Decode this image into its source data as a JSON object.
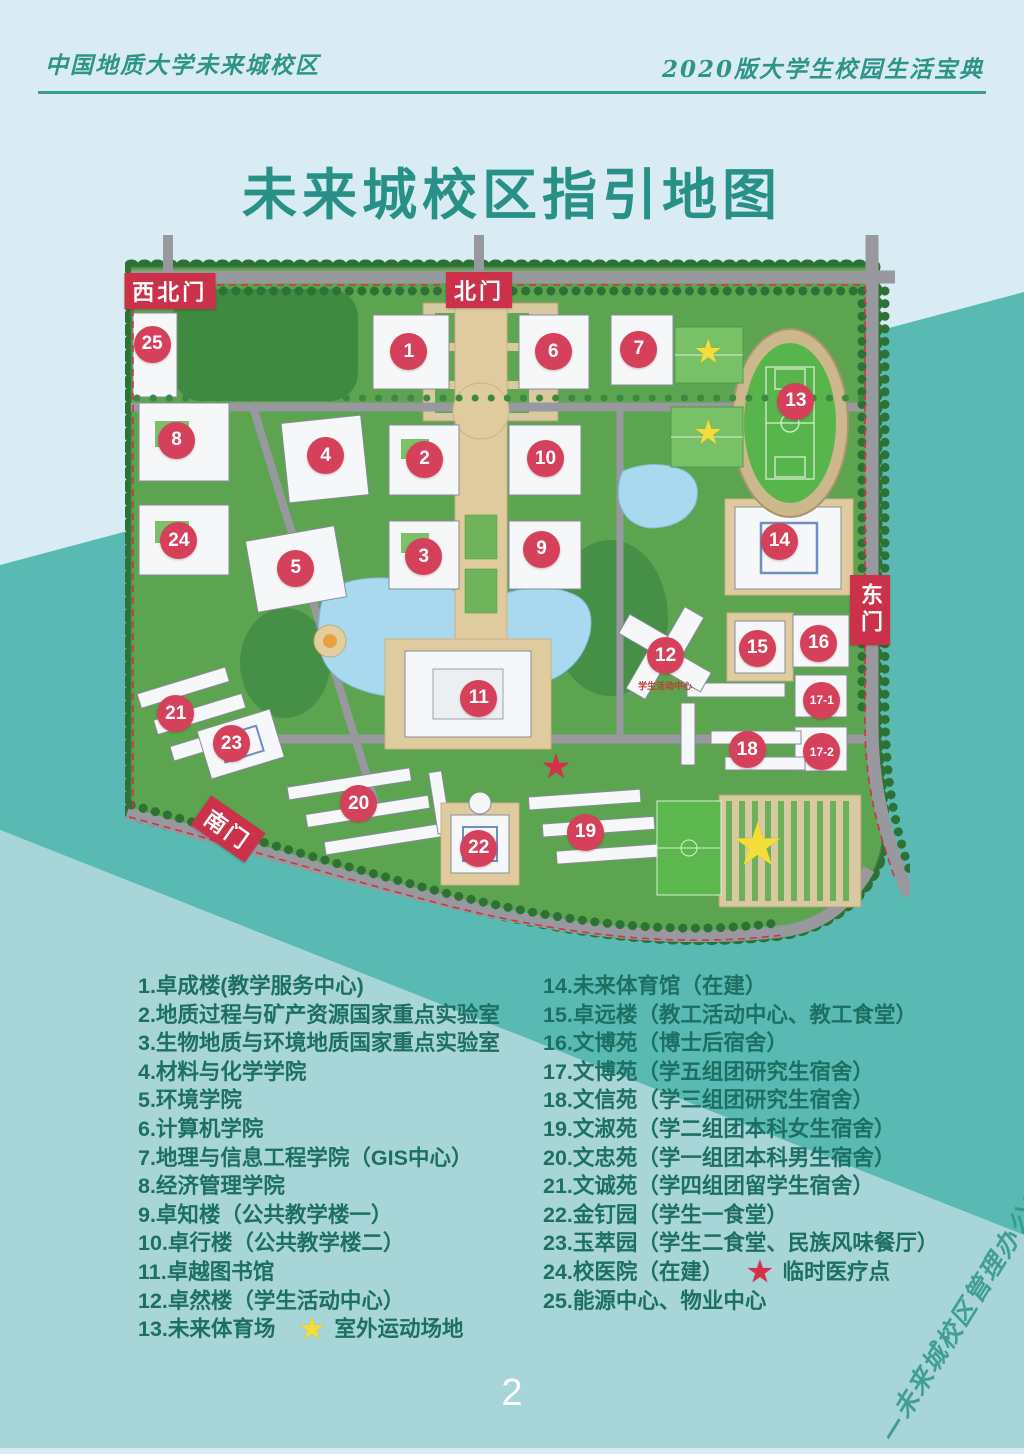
{
  "header": {
    "left": "中国地质大学未来城校区",
    "right": "2020版大学生校园生活宝典"
  },
  "title": "未来城校区指引地图",
  "page_number": "2",
  "watermark": "—未来城校区管理办公室—",
  "colors": {
    "page_bg": "#d9ecf3",
    "band_dark_teal": "#58bab2",
    "band_light_teal": "#a8d5d7",
    "header_teal": "#2e9488",
    "title_teal": "#289187",
    "legend_green": "#1d6f63",
    "marker_red": "#d5405a",
    "gate_red": "#cb3148",
    "star_yellow": "#f2dd3b",
    "star_red": "#d5304a"
  },
  "map": {
    "gates": [
      {
        "label": "西北门",
        "x": 5.7,
        "y": 7.9,
        "vertical": false,
        "rotate": 0
      },
      {
        "label": "北门",
        "x": 45.1,
        "y": 7.8,
        "vertical": false,
        "rotate": 0
      },
      {
        "label": "东门",
        "x": 94.9,
        "y": 51.4,
        "vertical": true,
        "rotate": 0
      },
      {
        "label": "南门",
        "x": 13.1,
        "y": 81.3,
        "vertical": false,
        "rotate": 35
      }
    ],
    "markers": [
      {
        "label": "1",
        "x": 36.1,
        "y": 16.1
      },
      {
        "label": "2",
        "x": 38.1,
        "y": 30.8
      },
      {
        "label": "3",
        "x": 38.0,
        "y": 44.1
      },
      {
        "label": "4",
        "x": 25.5,
        "y": 30.3
      },
      {
        "label": "5",
        "x": 21.7,
        "y": 45.7
      },
      {
        "label": "6",
        "x": 54.5,
        "y": 16.1
      },
      {
        "label": "7",
        "x": 65.4,
        "y": 15.8
      },
      {
        "label": "8",
        "x": 6.5,
        "y": 28.2
      },
      {
        "label": "9",
        "x": 53.0,
        "y": 43.1
      },
      {
        "label": "10",
        "x": 53.5,
        "y": 30.7
      },
      {
        "label": "11",
        "x": 45.0,
        "y": 63.4
      },
      {
        "label": "12",
        "x": 68.8,
        "y": 57.6
      },
      {
        "label": "13",
        "x": 85.4,
        "y": 22.9
      },
      {
        "label": "14",
        "x": 83.3,
        "y": 42.0
      },
      {
        "label": "15",
        "x": 80.5,
        "y": 56.6
      },
      {
        "label": "16",
        "x": 88.3,
        "y": 55.9
      },
      {
        "label": "17-1",
        "x": 88.7,
        "y": 63.7
      },
      {
        "label": "17-2",
        "x": 88.7,
        "y": 70.7
      },
      {
        "label": "18",
        "x": 79.2,
        "y": 70.4
      },
      {
        "label": "19",
        "x": 58.6,
        "y": 81.7
      },
      {
        "label": "20",
        "x": 29.7,
        "y": 77.8
      },
      {
        "label": "21",
        "x": 6.4,
        "y": 65.5
      },
      {
        "label": "22",
        "x": 45.0,
        "y": 83.9
      },
      {
        "label": "23",
        "x": 13.5,
        "y": 69.6
      },
      {
        "label": "24",
        "x": 6.8,
        "y": 41.9
      },
      {
        "label": "25",
        "x": 3.4,
        "y": 15.1
      }
    ],
    "stars": [
      {
        "color": "yellow",
        "x": 74.3,
        "y": 16.2,
        "size": 34
      },
      {
        "color": "yellow",
        "x": 74.3,
        "y": 27.3,
        "size": 34
      },
      {
        "color": "yellow",
        "x": 80.6,
        "y": 83.5,
        "size": 60
      },
      {
        "color": "red",
        "x": 54.9,
        "y": 72.9,
        "size": 34
      }
    ],
    "annotations": [
      {
        "text": "学生活动中心",
        "x": 68.8,
        "y": 60.8
      }
    ]
  },
  "legend": {
    "left": [
      {
        "text": "1.卓成楼(教学服务中心)"
      },
      {
        "text": "2.地质过程与矿产资源国家重点实验室"
      },
      {
        "text": "3.生物地质与环境地质国家重点实验室"
      },
      {
        "text": "4.材料与化学学院"
      },
      {
        "text": "5.环境学院"
      },
      {
        "text": "6.计算机学院"
      },
      {
        "text": "7.地理与信息工程学院（GIS中心）"
      },
      {
        "text": "8.经济管理学院"
      },
      {
        "text": " 9.卓知楼（公共教学楼一）"
      },
      {
        "text": "10.卓行楼（公共教学楼二）"
      },
      {
        "text": "11.卓越图书馆"
      },
      {
        "text": "12.卓然楼（学生活动中心）"
      },
      {
        "text": "13.未来体育场",
        "star": "yellow",
        "suffix": "室外运动场地"
      }
    ],
    "right": [
      {
        "text": "14.未来体育馆（在建）"
      },
      {
        "text": "15.卓远楼（教工活动中心、教工食堂）"
      },
      {
        "text": "16.文博苑（博士后宿舍）"
      },
      {
        "text": "17.文博苑（学五组团研究生宿舍）"
      },
      {
        "text": "18.文信苑（学三组团研究生宿舍）"
      },
      {
        "text": "19.文淑苑（学二组团本科女生宿舍）"
      },
      {
        "text": "20.文忠苑（学一组团本科男生宿舍）"
      },
      {
        "text": "21.文诚苑（学四组团留学生宿舍）"
      },
      {
        "text": "22.金钉园（学生一食堂）"
      },
      {
        "text": "23.玉萃园（学生二食堂、民族风味餐厅）"
      },
      {
        "text": "24.校医院（在建）",
        "star": "red",
        "suffix": "临时医疗点"
      },
      {
        "text": "25.能源中心、物业中心"
      }
    ]
  }
}
